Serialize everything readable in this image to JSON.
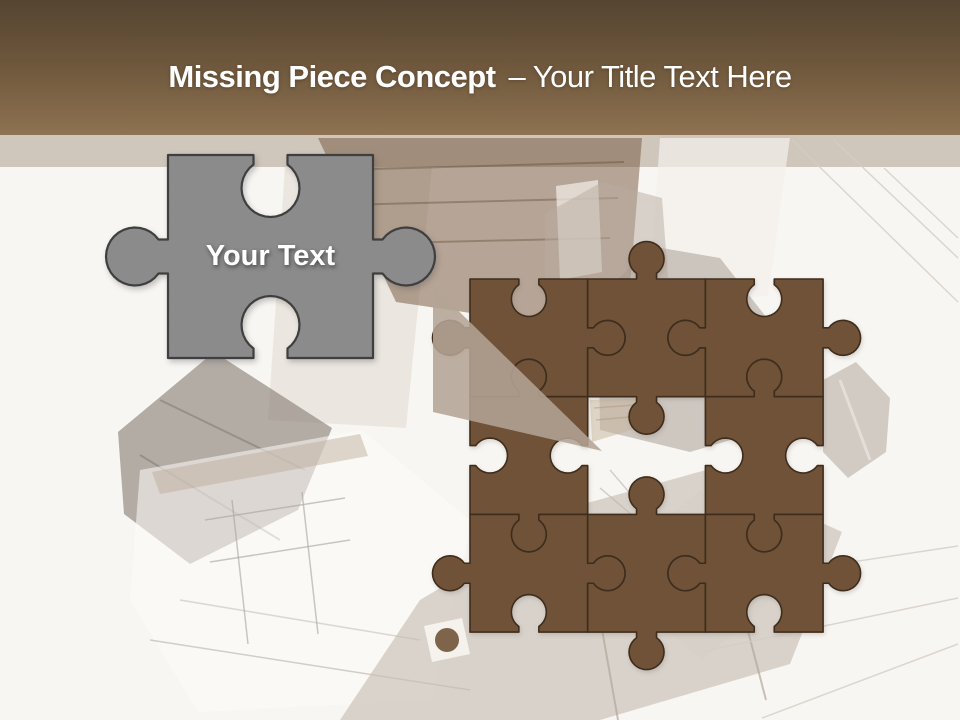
{
  "slide": {
    "title_bold": "Missing Piece Concept",
    "title_regular": "– Your Title Text Here",
    "piece_label": "Your Text"
  },
  "colors": {
    "background": "#f8f6f2",
    "band": "#cfc6bc",
    "header_top": "#554532",
    "header_mid": "#6e573c",
    "header_bottom": "#8e7251",
    "title_text": "#ffffff",
    "brown_piece_fill": "#6F5238",
    "brown_piece_stroke": "#3E2D1C",
    "gray_piece_fill": "#8B8B8B",
    "gray_piece_stroke": "#3F3F3F",
    "beam_fill": "#B3A495",
    "label_text": "#ffffff"
  },
  "puzzle": {
    "origin": [
      470,
      279
    ],
    "cell": 117.7,
    "rows": 3,
    "cols": 3,
    "missing_cell": {
      "row": 2,
      "col": 2
    },
    "pieces": [
      {
        "row": 1,
        "col": 1,
        "edges": [
          "blank",
          "tab",
          "blank",
          "tab"
        ]
      },
      {
        "row": 1,
        "col": 2,
        "edges": [
          "tab",
          "blank",
          "tab",
          "blank"
        ]
      },
      {
        "row": 1,
        "col": 3,
        "edges": [
          "blank",
          "tab",
          "blank",
          "tab"
        ]
      },
      {
        "row": 2,
        "col": 1,
        "edges": [
          "tab",
          "blank",
          "tab",
          "blank"
        ]
      },
      {
        "row": 2,
        "col": 3,
        "edges": [
          "tab",
          "blank",
          "tab",
          "blank"
        ]
      },
      {
        "row": 3,
        "col": 1,
        "edges": [
          "blank",
          "tab",
          "blank",
          "tab"
        ]
      },
      {
        "row": 3,
        "col": 2,
        "edges": [
          "tab",
          "blank",
          "tab",
          "blank"
        ]
      },
      {
        "row": 3,
        "col": 3,
        "edges": [
          "blank",
          "tab",
          "blank",
          "tab"
        ]
      }
    ]
  },
  "gray_piece": {
    "x": 168,
    "y": 155,
    "w": 205,
    "h": 203,
    "edges": [
      "blank",
      "tab",
      "blank",
      "tab"
    ]
  },
  "beam": {
    "points": [
      [
        433,
        286
      ],
      [
        433,
        412
      ],
      [
        602,
        451
      ]
    ],
    "opacity": 0.87
  },
  "background": {
    "band": {
      "y": 135,
      "h": 32
    },
    "shapes": [
      {
        "kind": "polygon",
        "name": "sheet-behind-gray",
        "pts": [
          [
            285,
            167
          ],
          [
            432,
            167
          ],
          [
            406,
            428
          ],
          [
            268,
            420
          ]
        ],
        "fill": "#DCD4CA",
        "op": 0.45
      },
      {
        "kind": "polygon",
        "name": "slat-house",
        "pts": [
          [
            318,
            138
          ],
          [
            642,
            138
          ],
          [
            630,
            286
          ],
          [
            518,
            320
          ],
          [
            396,
            302
          ]
        ],
        "fill": "#73543A",
        "op": 0.5
      },
      {
        "kind": "line",
        "name": "slat-line",
        "x1": 336,
        "y1": 170,
        "x2": 624,
        "y2": 162,
        "stroke": "#55402B",
        "w": 2,
        "op": 0.35
      },
      {
        "kind": "line",
        "name": "slat-line",
        "x1": 340,
        "y1": 205,
        "x2": 618,
        "y2": 198,
        "stroke": "#55402B",
        "w": 2,
        "op": 0.35
      },
      {
        "kind": "line",
        "name": "slat-line",
        "x1": 346,
        "y1": 244,
        "x2": 610,
        "y2": 238,
        "stroke": "#55402B",
        "w": 2,
        "op": 0.35
      },
      {
        "kind": "polygon",
        "name": "house-door",
        "pts": [
          [
            556,
            186
          ],
          [
            598,
            180
          ],
          [
            602,
            272
          ],
          [
            560,
            280
          ]
        ],
        "fill": "#F3F0EA",
        "op": 0.7
      },
      {
        "kind": "polygon",
        "name": "white-gap",
        "pts": [
          [
            660,
            138
          ],
          [
            790,
            138
          ],
          [
            768,
            296
          ],
          [
            648,
            306
          ]
        ],
        "fill": "#F4F1EC",
        "op": 0.7
      },
      {
        "kind": "polygon",
        "name": "gable-house",
        "pts": [
          [
            598,
            300
          ],
          [
            650,
            246
          ],
          [
            720,
            258
          ],
          [
            770,
            322
          ],
          [
            764,
            430
          ],
          [
            690,
            452
          ],
          [
            600,
            430
          ]
        ],
        "fill": "#8E8276",
        "op": 0.4
      },
      {
        "kind": "line",
        "name": "gable-ridge",
        "x1": 650,
        "y1": 246,
        "x2": 640,
        "y2": 420,
        "stroke": "#7A6F64",
        "w": 2,
        "op": 0.4
      },
      {
        "kind": "polygon",
        "name": "taupe-block",
        "pts": [
          [
            545,
            214
          ],
          [
            602,
            182
          ],
          [
            662,
            198
          ],
          [
            668,
            278
          ],
          [
            545,
            278
          ]
        ],
        "fill": "#B7ACA0",
        "op": 0.5
      },
      {
        "kind": "polygon",
        "name": "right-house",
        "pts": [
          [
            823,
            380
          ],
          [
            856,
            362
          ],
          [
            890,
            398
          ],
          [
            886,
            452
          ],
          [
            848,
            478
          ],
          [
            823,
            452
          ]
        ],
        "fill": "#B3A89C",
        "op": 0.55
      },
      {
        "kind": "line",
        "name": "right-house-streak",
        "x1": 840,
        "y1": 380,
        "x2": 870,
        "y2": 460,
        "stroke": "#EFEBE5",
        "w": 3,
        "op": 0.6
      },
      {
        "kind": "polygon",
        "name": "left-roof",
        "pts": [
          [
            118,
            432
          ],
          [
            214,
            352
          ],
          [
            332,
            428
          ],
          [
            298,
            510
          ],
          [
            190,
            564
          ],
          [
            124,
            514
          ]
        ],
        "fill": "#857C72",
        "op": 0.6
      },
      {
        "kind": "line",
        "name": "left-roof-slat",
        "x1": 160,
        "y1": 400,
        "x2": 305,
        "y2": 470,
        "stroke": "#6F675E",
        "w": 2,
        "op": 0.4
      },
      {
        "kind": "line",
        "name": "left-roof-slat",
        "x1": 140,
        "y1": 455,
        "x2": 280,
        "y2": 540,
        "stroke": "#6F675E",
        "w": 2,
        "op": 0.4
      },
      {
        "kind": "polygon",
        "name": "plan-sheet",
        "pts": [
          [
            140,
            470
          ],
          [
            362,
            430
          ],
          [
            472,
            522
          ],
          [
            432,
            700
          ],
          [
            198,
            712
          ],
          [
            130,
            600
          ]
        ],
        "fill": "#FDFCFA",
        "op": 0.55
      },
      {
        "kind": "polygon",
        "name": "plan-wall-band",
        "pts": [
          [
            152,
            472
          ],
          [
            360,
            434
          ],
          [
            368,
            456
          ],
          [
            160,
            494
          ]
        ],
        "fill": "#B9A894",
        "op": 0.45
      },
      {
        "kind": "line",
        "name": "plan-line",
        "x1": 205,
        "y1": 520,
        "x2": 345,
        "y2": 498,
        "stroke": "#A9A29A",
        "w": 1.5,
        "op": 0.6
      },
      {
        "kind": "line",
        "name": "plan-line",
        "x1": 210,
        "y1": 562,
        "x2": 350,
        "y2": 540,
        "stroke": "#A9A29A",
        "w": 1.5,
        "op": 0.6
      },
      {
        "kind": "line",
        "name": "plan-line",
        "x1": 232,
        "y1": 500,
        "x2": 248,
        "y2": 644,
        "stroke": "#A9A29A",
        "w": 1.5,
        "op": 0.6
      },
      {
        "kind": "line",
        "name": "plan-line",
        "x1": 302,
        "y1": 492,
        "x2": 318,
        "y2": 634,
        "stroke": "#A9A29A",
        "w": 1.5,
        "op": 0.6
      },
      {
        "kind": "line",
        "name": "plan-line",
        "x1": 150,
        "y1": 640,
        "x2": 470,
        "y2": 690,
        "stroke": "#A9A29A",
        "w": 1.5,
        "op": 0.5
      },
      {
        "kind": "line",
        "name": "plan-line",
        "x1": 180,
        "y1": 600,
        "x2": 420,
        "y2": 640,
        "stroke": "#A9A29A",
        "w": 1.5,
        "op": 0.4
      },
      {
        "kind": "polygon",
        "name": "big-roof",
        "pts": [
          [
            340,
            720
          ],
          [
            420,
            600
          ],
          [
            580,
            505
          ],
          [
            706,
            470
          ],
          [
            842,
            532
          ],
          [
            790,
            664
          ],
          [
            600,
            720
          ]
        ],
        "fill": "#C6BEB4",
        "op": 0.65
      },
      {
        "kind": "line",
        "name": "roof-ridge",
        "x1": 580,
        "y1": 505,
        "x2": 618,
        "y2": 720,
        "stroke": "#B2A89C",
        "w": 2,
        "op": 0.7
      },
      {
        "kind": "line",
        "name": "roof-ridge",
        "x1": 706,
        "y1": 470,
        "x2": 766,
        "y2": 700,
        "stroke": "#B2A89C",
        "w": 2,
        "op": 0.7
      },
      {
        "kind": "polygon",
        "name": "roof-light",
        "pts": [
          [
            600,
            575
          ],
          [
            700,
            490
          ],
          [
            800,
            575
          ],
          [
            702,
            660
          ]
        ],
        "fill": "#D6CFC6",
        "op": 0.6
      },
      {
        "kind": "polygon",
        "name": "chimney-pad",
        "pts": [
          [
            424,
            626
          ],
          [
            462,
            618
          ],
          [
            470,
            654
          ],
          [
            432,
            662
          ]
        ],
        "fill": "#FAF8F5",
        "op": 0.85
      },
      {
        "kind": "circle",
        "name": "chimney",
        "cx": 447,
        "cy": 640,
        "r": 12,
        "fill": "#6E5036",
        "op": 0.88
      },
      {
        "kind": "polygon",
        "name": "hole-slats",
        "pts": [
          [
            590,
            400
          ],
          [
            656,
            398
          ],
          [
            638,
            428
          ],
          [
            592,
            442
          ]
        ],
        "fill": "#C6B49C",
        "op": 0.5
      },
      {
        "kind": "line",
        "name": "hole-slat-line",
        "x1": 594,
        "y1": 408,
        "x2": 648,
        "y2": 404,
        "stroke": "#AD9A80",
        "w": 1.5,
        "op": 0.5
      },
      {
        "kind": "line",
        "name": "hole-slat-line",
        "x1": 596,
        "y1": 420,
        "x2": 640,
        "y2": 416,
        "stroke": "#AD9A80",
        "w": 1.5,
        "op": 0.5
      },
      {
        "kind": "line",
        "name": "hole-furniture",
        "x1": 610,
        "y1": 470,
        "x2": 640,
        "y2": 505,
        "stroke": "#BDB6AE",
        "w": 1.5,
        "op": 0.6
      },
      {
        "kind": "line",
        "name": "hole-furniture",
        "x1": 600,
        "y1": 488,
        "x2": 632,
        "y2": 515,
        "stroke": "#BDB6AE",
        "w": 1.5,
        "op": 0.6
      },
      {
        "kind": "line",
        "name": "blueprint-line",
        "x1": 792,
        "y1": 140,
        "x2": 958,
        "y2": 302,
        "stroke": "#D5CEC6",
        "w": 1.5,
        "op": 0.8
      },
      {
        "kind": "line",
        "name": "blueprint-line",
        "x1": 834,
        "y1": 140,
        "x2": 958,
        "y2": 258,
        "stroke": "#D5CEC6",
        "w": 1.5,
        "op": 0.8
      },
      {
        "kind": "line",
        "name": "blueprint-line",
        "x1": 884,
        "y1": 168,
        "x2": 958,
        "y2": 238,
        "stroke": "#D5CEC6",
        "w": 1.5,
        "op": 0.8
      },
      {
        "kind": "line",
        "name": "blueprint-line",
        "x1": 700,
        "y1": 652,
        "x2": 958,
        "y2": 598,
        "stroke": "#D5CEC6",
        "w": 1.5,
        "op": 0.8
      },
      {
        "kind": "line",
        "name": "blueprint-line",
        "x1": 762,
        "y1": 718,
        "x2": 958,
        "y2": 644,
        "stroke": "#D5CEC6",
        "w": 1.5,
        "op": 0.8
      },
      {
        "kind": "line",
        "name": "blueprint-line",
        "x1": 852,
        "y1": 562,
        "x2": 958,
        "y2": 546,
        "stroke": "#D5CEC6",
        "w": 1.5,
        "op": 0.8
      }
    ]
  }
}
